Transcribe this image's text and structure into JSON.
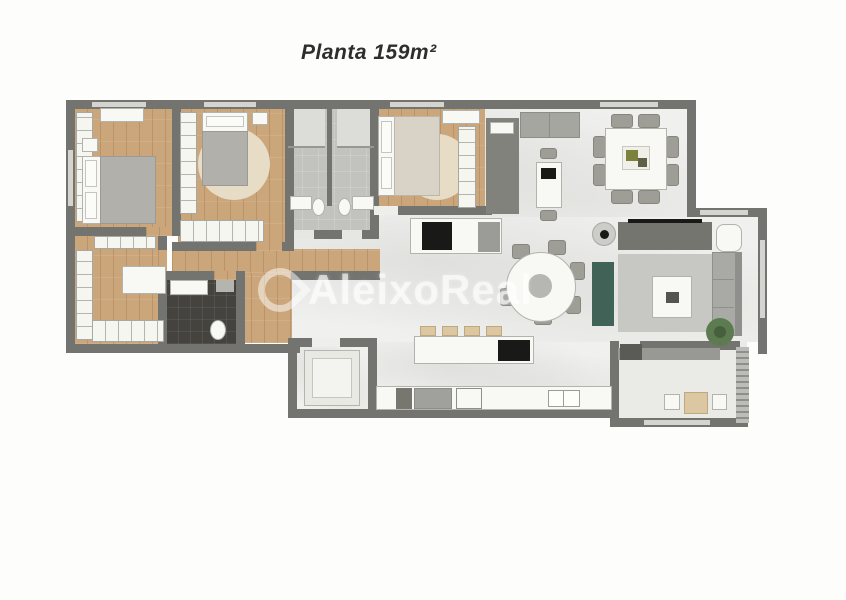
{
  "title": "Planta 159m²",
  "watermark": {
    "text": "AleixoReal"
  },
  "plan": {
    "area_label": "159m²",
    "rooms": [
      "bedroom-1",
      "bedroom-2",
      "bathroom-1",
      "bathroom-2",
      "master-bedroom",
      "walk-in-closet",
      "master-bathroom",
      "hall",
      "laundry",
      "kitchen",
      "dining-area",
      "living-room",
      "gourmet-balcony"
    ]
  },
  "colors": {
    "wall": "#73736f",
    "wood_floor": "#cba67b",
    "marble_floor": "#f0f0ee",
    "bath_tile": "#c2c2bf",
    "dark_bath_tile": "#44433e",
    "white_furniture": "#f8f8f4",
    "gray_furniture": "#a6a6a1",
    "green_accent": "#416257",
    "stool_beige": "#dbc8a2",
    "appliance_black": "#191917",
    "title_text": "#2e2e2e"
  }
}
